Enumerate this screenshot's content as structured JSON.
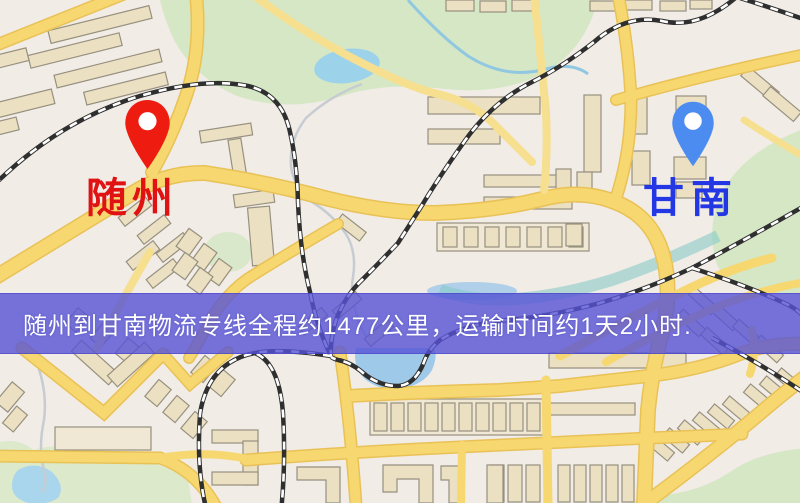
{
  "banner": {
    "text": "随州到甘南物流专线全程约1477公里，运输时间约1天2小时.",
    "background_color": "rgba(86,82,214,0.80)",
    "text_color": "#FFFFFF"
  },
  "markers": {
    "origin": {
      "label": "随州",
      "pin_color": "#EE1B10",
      "label_color": "#E01212"
    },
    "destination": {
      "label": "甘南",
      "pin_color": "#4C8CF0",
      "label_color": "#2338E4"
    }
  },
  "map_palette": {
    "background": "#F1ECE6",
    "road_fill": "#F7D76F",
    "road_casing": "#E9C257",
    "park": "#D5E7C5",
    "water": "#9FC9E8",
    "railway": "#2F2F2F",
    "building_fill": "#EBE0C2",
    "building_outline": "#97907F"
  }
}
